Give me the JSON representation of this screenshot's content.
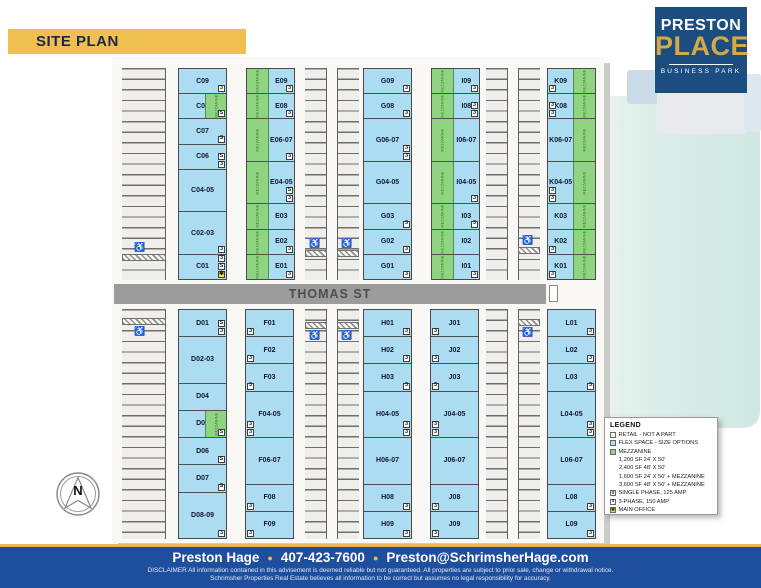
{
  "banner": {
    "label": "SITE PLAN"
  },
  "logo": {
    "line1": "PRESTON",
    "line2": "PLACE",
    "line3": "BUSINESS PARK"
  },
  "colors": {
    "flex_blue": "#abdcf2",
    "mezzanine_green": "#8ed481",
    "retail_cream": "#f7f4da",
    "street_gray": "#9c9c9c",
    "banner_yellow": "#efc04f",
    "logo_navy": "#1b4d80",
    "logo_gold": "#d3aa45",
    "footer_blue": "#1e4f9f",
    "accent_gold": "#e5ba4e",
    "star_yellow": "#f2e93a"
  },
  "plan": {
    "street_label": "THOMAS ST",
    "mezzanine_label": "MEZZANINE",
    "compass_label": "N",
    "rows": [
      {
        "name": "north",
        "buildings": [
          {
            "id": "C",
            "mezz": "none",
            "units": [
              {
                "label": "C09",
                "bays": 1,
                "badges": [
                  "3"
                ]
              },
              {
                "label": "C08",
                "bays": 1,
                "badges": [
                  "S"
                ],
                "mezz": "right"
              },
              {
                "label": "C07",
                "bays": 1,
                "badges": [
                  "S"
                ]
              },
              {
                "label": "C06",
                "bays": 1,
                "badges": [
                  "S",
                  "3"
                ]
              },
              {
                "label": "C04-05",
                "bays": 2,
                "badges": []
              },
              {
                "label": "C02-03",
                "bays": 2,
                "badges": [
                  "3"
                ]
              },
              {
                "label": "C01",
                "bays": 1,
                "badges": [
                  "3",
                  "S",
                  "star"
                ]
              }
            ]
          },
          {
            "id": "E",
            "mezz": "left",
            "units": [
              {
                "label": "E09",
                "bays": 1,
                "badges": [
                  "3"
                ]
              },
              {
                "label": "E08",
                "bays": 1,
                "badges": [
                  "3"
                ]
              },
              {
                "label": "E06-07",
                "bays": 2,
                "badges": [
                  "3"
                ]
              },
              {
                "label": "E04-05",
                "bays": 2,
                "badges": [
                  "S",
                  "3"
                ]
              },
              {
                "label": "E03",
                "bays": 1,
                "badges": []
              },
              {
                "label": "E02",
                "bays": 1,
                "badges": [
                  "3"
                ]
              },
              {
                "label": "E01",
                "bays": 1,
                "badges": [
                  "3"
                ]
              }
            ]
          },
          {
            "id": "G",
            "mezz": "none",
            "units": [
              {
                "label": "G09",
                "bays": 1,
                "badges": [
                  "3"
                ]
              },
              {
                "label": "G08",
                "bays": 1,
                "badges": [
                  "3"
                ]
              },
              {
                "label": "G06-07",
                "bays": 2,
                "badges": [
                  "3",
                  "3"
                ]
              },
              {
                "label": "G04-05",
                "bays": 2,
                "badges": []
              },
              {
                "label": "G03",
                "bays": 1,
                "badges": [
                  "3"
                ]
              },
              {
                "label": "G02",
                "bays": 1,
                "badges": [
                  "3"
                ]
              },
              {
                "label": "G01",
                "bays": 1,
                "badges": [
                  "3"
                ]
              }
            ]
          },
          {
            "id": "I",
            "mezz": "left",
            "units": [
              {
                "label": "I09",
                "bays": 1,
                "badges": [
                  "3"
                ]
              },
              {
                "label": "I08",
                "bays": 1,
                "badges": [
                  "3",
                  "3"
                ]
              },
              {
                "label": "I06-07",
                "bays": 2,
                "badges": []
              },
              {
                "label": "I04-05",
                "bays": 2,
                "badges": [
                  "3"
                ]
              },
              {
                "label": "I03",
                "bays": 1,
                "badges": [
                  "3"
                ]
              },
              {
                "label": "I02",
                "bays": 1,
                "badges": []
              },
              {
                "label": "I01",
                "bays": 1,
                "badges": [
                  "3"
                ]
              }
            ]
          },
          {
            "id": "K",
            "mezz": "right",
            "units": [
              {
                "label": "K09",
                "bays": 1,
                "badges": [
                  "3"
                ]
              },
              {
                "label": "K08",
                "bays": 1,
                "badges": [
                  "3",
                  "3"
                ]
              },
              {
                "label": "K06-07",
                "bays": 2,
                "badges": []
              },
              {
                "label": "K04-05",
                "bays": 2,
                "badges": [
                  "3",
                  "3"
                ]
              },
              {
                "label": "K03",
                "bays": 1,
                "badges": []
              },
              {
                "label": "K02",
                "bays": 1,
                "badges": [
                  "3"
                ]
              },
              {
                "label": "K01",
                "bays": 1,
                "badges": [
                  "3"
                ]
              }
            ]
          }
        ]
      },
      {
        "name": "south",
        "buildings": [
          {
            "id": "D",
            "mezz": "none",
            "units": [
              {
                "label": "D01",
                "bays": 1,
                "badges": [
                  "S",
                  "3"
                ]
              },
              {
                "label": "D02-03",
                "bays": 2,
                "badges": []
              },
              {
                "label": "D04",
                "bays": 1,
                "badges": []
              },
              {
                "label": "D05",
                "bays": 1,
                "badges": [
                  "S"
                ],
                "mezz": "right"
              },
              {
                "label": "D06",
                "bays": 1,
                "badges": [
                  "S"
                ]
              },
              {
                "label": "D07",
                "bays": 1,
                "badges": [
                  "S"
                ]
              },
              {
                "label": "D08-09",
                "bays": 2,
                "badges": [
                  "3"
                ]
              }
            ]
          },
          {
            "id": "F",
            "mezz": "none",
            "units": [
              {
                "label": "F01",
                "bays": 1,
                "badges": [
                  "3"
                ]
              },
              {
                "label": "F02",
                "bays": 1,
                "badges": [
                  "3"
                ]
              },
              {
                "label": "F03",
                "bays": 1,
                "badges": [
                  "3"
                ]
              },
              {
                "label": "F04-05",
                "bays": 2,
                "badges": [
                  "3",
                  "3"
                ]
              },
              {
                "label": "F06-07",
                "bays": 2,
                "badges": []
              },
              {
                "label": "F08",
                "bays": 1,
                "badges": [
                  "3"
                ]
              },
              {
                "label": "F09",
                "bays": 1,
                "badges": [
                  "3"
                ]
              }
            ]
          },
          {
            "id": "H",
            "mezz": "none",
            "units": [
              {
                "label": "H01",
                "bays": 1,
                "badges": [
                  "3"
                ]
              },
              {
                "label": "H02",
                "bays": 1,
                "badges": [
                  "3"
                ]
              },
              {
                "label": "H03",
                "bays": 1,
                "badges": [
                  "3"
                ]
              },
              {
                "label": "H04-05",
                "bays": 2,
                "badges": [
                  "3",
                  "3"
                ]
              },
              {
                "label": "H06-07",
                "bays": 2,
                "badges": []
              },
              {
                "label": "H08",
                "bays": 1,
                "badges": [
                  "3"
                ]
              },
              {
                "label": "H09",
                "bays": 1,
                "badges": [
                  "3"
                ]
              }
            ]
          },
          {
            "id": "J",
            "mezz": "none",
            "units": [
              {
                "label": "J01",
                "bays": 1,
                "badges": [
                  "3"
                ]
              },
              {
                "label": "J02",
                "bays": 1,
                "badges": [
                  "3"
                ]
              },
              {
                "label": "J03",
                "bays": 1,
                "badges": [
                  "3"
                ]
              },
              {
                "label": "J04-05",
                "bays": 2,
                "badges": [
                  "3",
                  "3"
                ]
              },
              {
                "label": "J06-07",
                "bays": 2,
                "badges": []
              },
              {
                "label": "J08",
                "bays": 1,
                "badges": [
                  "3"
                ]
              },
              {
                "label": "J09",
                "bays": 1,
                "badges": [
                  "3"
                ]
              }
            ]
          },
          {
            "id": "L",
            "mezz": "none",
            "units": [
              {
                "label": "L01",
                "bays": 1,
                "badges": [
                  "3"
                ]
              },
              {
                "label": "L02",
                "bays": 1,
                "badges": [
                  "3"
                ]
              },
              {
                "label": "L03",
                "bays": 1,
                "badges": [
                  "3"
                ]
              },
              {
                "label": "L04-05",
                "bays": 2,
                "badges": [
                  "3",
                  "3"
                ]
              },
              {
                "label": "L06-07",
                "bays": 2,
                "badges": []
              },
              {
                "label": "L08",
                "bays": 1,
                "badges": [
                  "3"
                ]
              },
              {
                "label": "L09",
                "bays": 1,
                "badges": [
                  "3"
                ]
              }
            ]
          }
        ]
      }
    ]
  },
  "legend": {
    "title": "LEGEND",
    "items": [
      {
        "swatch": "retail",
        "label": "RETAIL - NOT A PART"
      },
      {
        "swatch": "flex",
        "label": "FLEX SPACE - SIZE OPTIONS"
      },
      {
        "swatch": "mezz",
        "label": "MEZZANINE"
      },
      {
        "swatch": null,
        "label": "1,200 SF 24' X 50'"
      },
      {
        "swatch": null,
        "label": "2,400 SF 48' X 50'"
      },
      {
        "swatch": null,
        "label": "1,600 SF 24' X 50' + MEZZANINE"
      },
      {
        "swatch": null,
        "label": "3,600 SF 48' X 50' + MEZZANINE"
      },
      {
        "swatch": "S",
        "label": "SINGLE PHASE, 125 AMP"
      },
      {
        "swatch": "3",
        "label": "3-PHASE, 150 AMP"
      },
      {
        "swatch": "star",
        "label": "MAIN OFFICE"
      }
    ]
  },
  "footer": {
    "name": "Preston Hage",
    "phone": "407-423-7600",
    "email": "Preston@SchrimsherHage.com",
    "disclaimer1": "DISCLAIMER All information contained in this advisement is deemed reliable but not guaranteed. All properties are subject to prior sale, change or withdrawal notice.",
    "disclaimer2": "Schrimsher Properties Real Estate believes all information to be correct but assumes no legal responsibility for accuracy."
  }
}
